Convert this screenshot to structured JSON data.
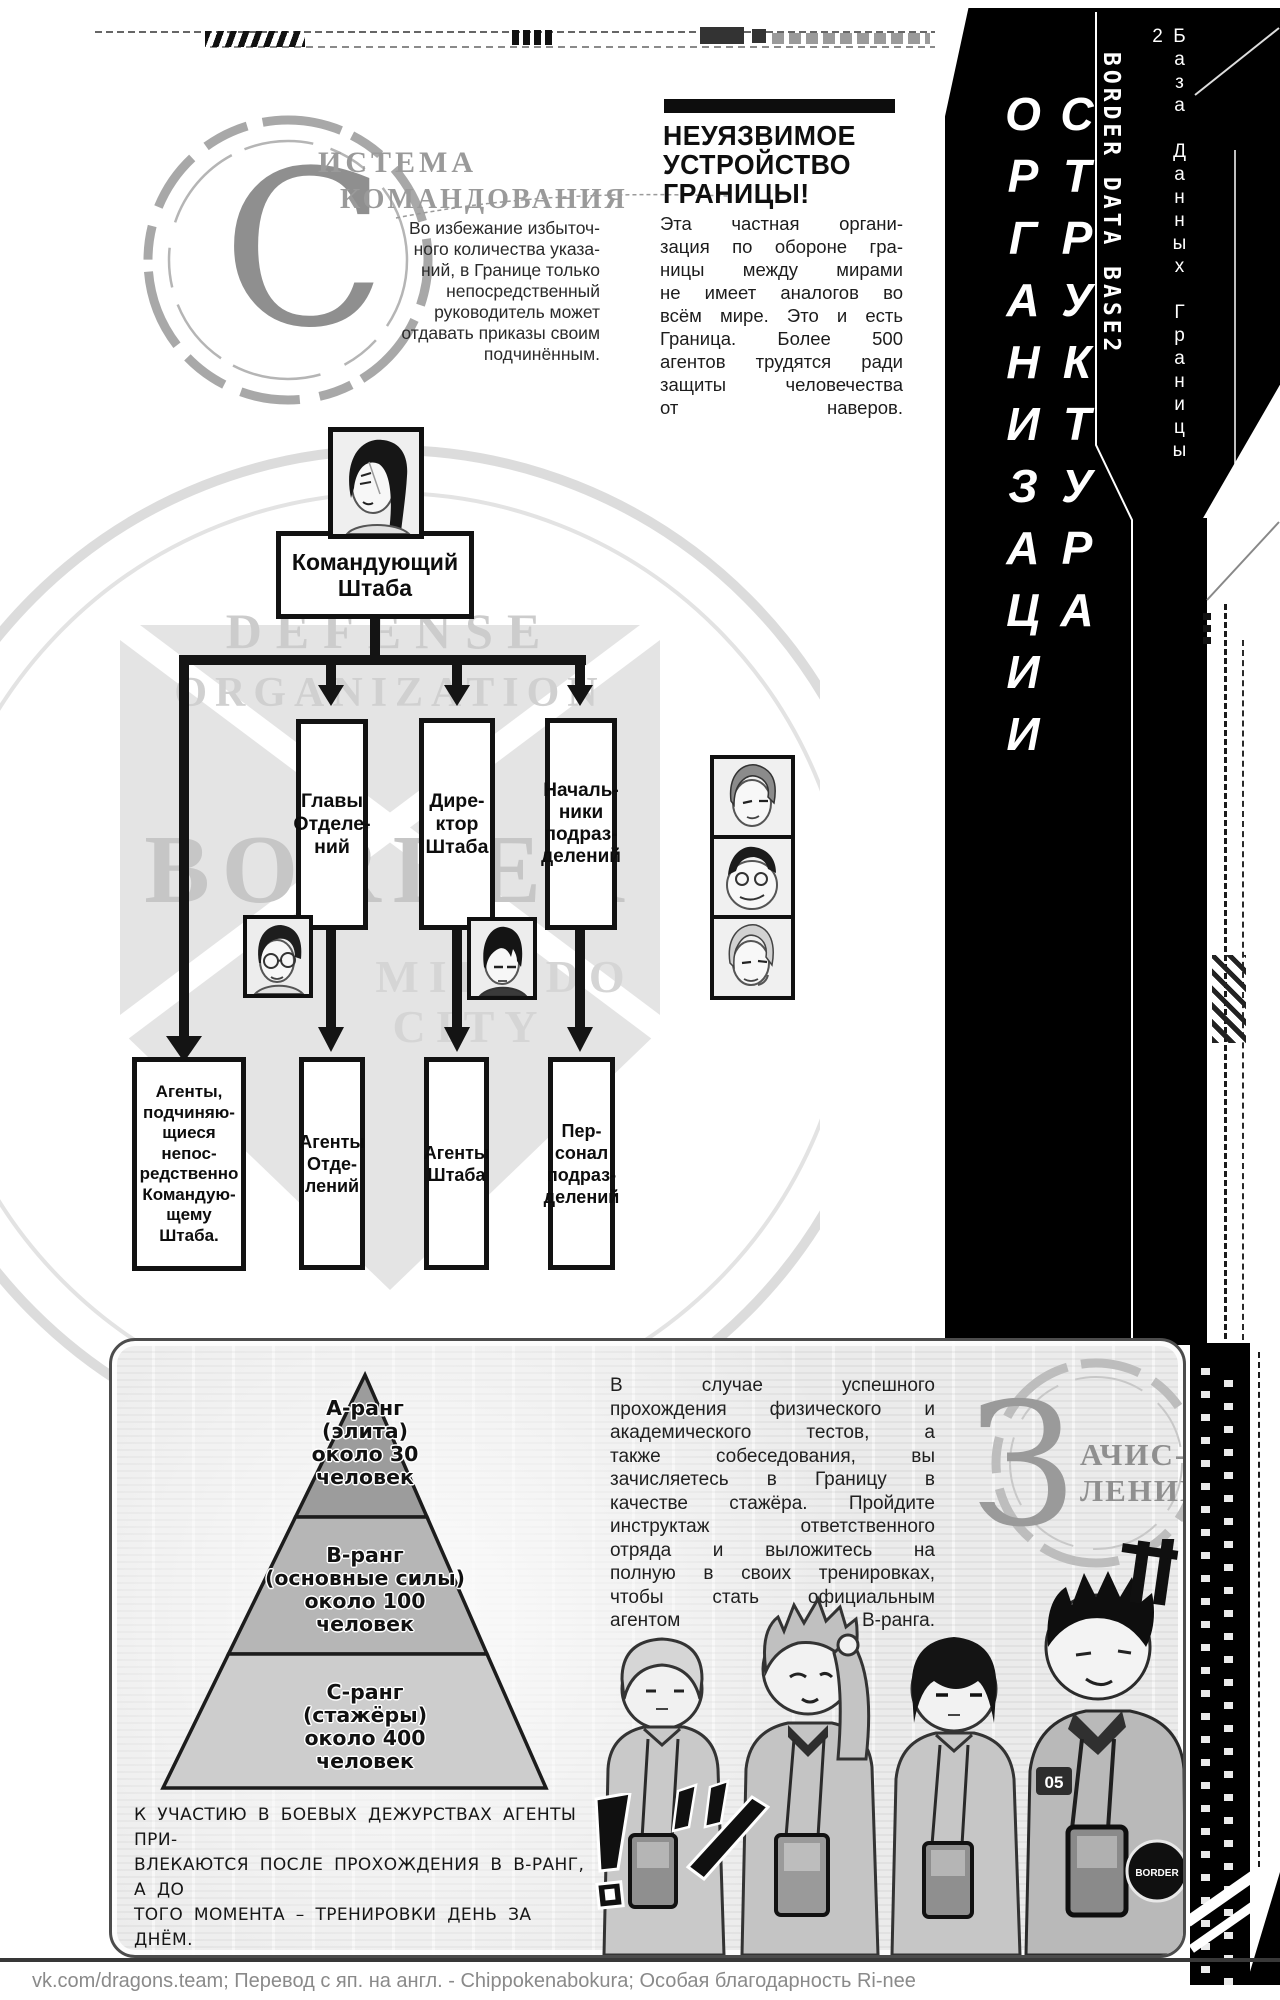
{
  "colors": {
    "sidebar_bg": "#000000",
    "sidebar_text": "#ffffff",
    "ink": "#111111",
    "panel_bg": "#ebebeb",
    "muted_gray": "#9a9a9a"
  },
  "command_system": {
    "initial": "С",
    "title_line1": "ИСТЕМА",
    "title_line2": "КОМАНДОВАНИЯ",
    "body": "Во избежание избыточ-\nного количества указа-\nний, в Границе только\nнепосредственный\nруководитель может\nотдавать приказы своим\nподчинённым."
  },
  "border_info": {
    "title": "НЕУЯЗВИМОЕ\nУСТРОЙСТВО\nГРАНИЦЫ!",
    "body": "Эта частная органи-\nзация по обороне гра-\nницы между мирами\nне имеет аналогов во\nвсём мире. Это и есть\nГраница. Более 500\nагентов трудятся ради\nзащиты человечества\nот наверов."
  },
  "sidebar": {
    "title_vertical": "СТРУКТУРА ОРГАНИЗАЦИИ",
    "db_label_en": "BORDER DATA BASE2",
    "db_label_ru": "База Данных Границы 2"
  },
  "org_chart": {
    "watermark_arc_top": "DEFENSE",
    "watermark_arc_mid": "ORGANIZATION",
    "watermark_name": "BORDER",
    "watermark_city_1": "MIKADO",
    "watermark_city_2": "CITY",
    "root_label": "Командующий\nШтаба",
    "mid_labels": [
      "Главы\nОтделе-\nний",
      "Дире-\nктор\nШтаба",
      "Началь-\nники\nподраз-\nделений"
    ],
    "bottom_labels": [
      "Агенты,\nподчиняю-\nщиеся непос-\nредственно\nКомандую-\nщему Штаба.",
      "Агенты\nОтде-\nлений",
      "Агенты\nШтаба",
      "Пер-\nсонал\nподраз-\nделений"
    ]
  },
  "recruitment": {
    "initial": "З",
    "title_rest": "АЧИС-\nЛЕНИЕ",
    "body": "В случае успешного\nпрохождения физического и\nакадемического тестов, а\nтакже собеседования, вы\nзачисляетесь в Границу в\nкачестве стажёра. Пройдите\nинструктаж ответственного\nотряда и выложитесь на\nполную в своих тренировках,\nчтобы стать официальным\nагентом В-ранга.",
    "pyramid": {
      "type": "pyramid",
      "tiers": [
        {
          "rank": "А-ранг",
          "note": "элита",
          "count": 30,
          "label": "А-ранг\n(элита)\nоколо 30\nчеловек"
        },
        {
          "rank": "В-ранг",
          "note": "основные силы",
          "count": 100,
          "label": "В-ранг\n(основные силы)\nоколо 100\nчеловек"
        },
        {
          "rank": "С-ранг",
          "note": "стажёры",
          "count": 400,
          "label": "С-ранг\n(стажёры)\nоколо 400\nчеловек"
        }
      ]
    },
    "caption": "К УЧАСТИЮ В БОЕВЫХ ДЕЖУРСТВАХ АГЕНТЫ ПРИ-\nВЛЕКАЮТСЯ ПОСЛЕ ПРОХОЖДЕНИЯ В В-РАНГ, А ДО\nТОГО МОМЕНТА – ТРЕНИРОВКИ ДЕНЬ ЗА ДНЁМ.",
    "shoulder_badge": "05",
    "arm_patch": "BORDER"
  },
  "footer": {
    "credits": "vk.com/dragons.team;   Перевод с яп. на англ. - Chippokenabokura;   Особая благодарность Ri-nee"
  }
}
